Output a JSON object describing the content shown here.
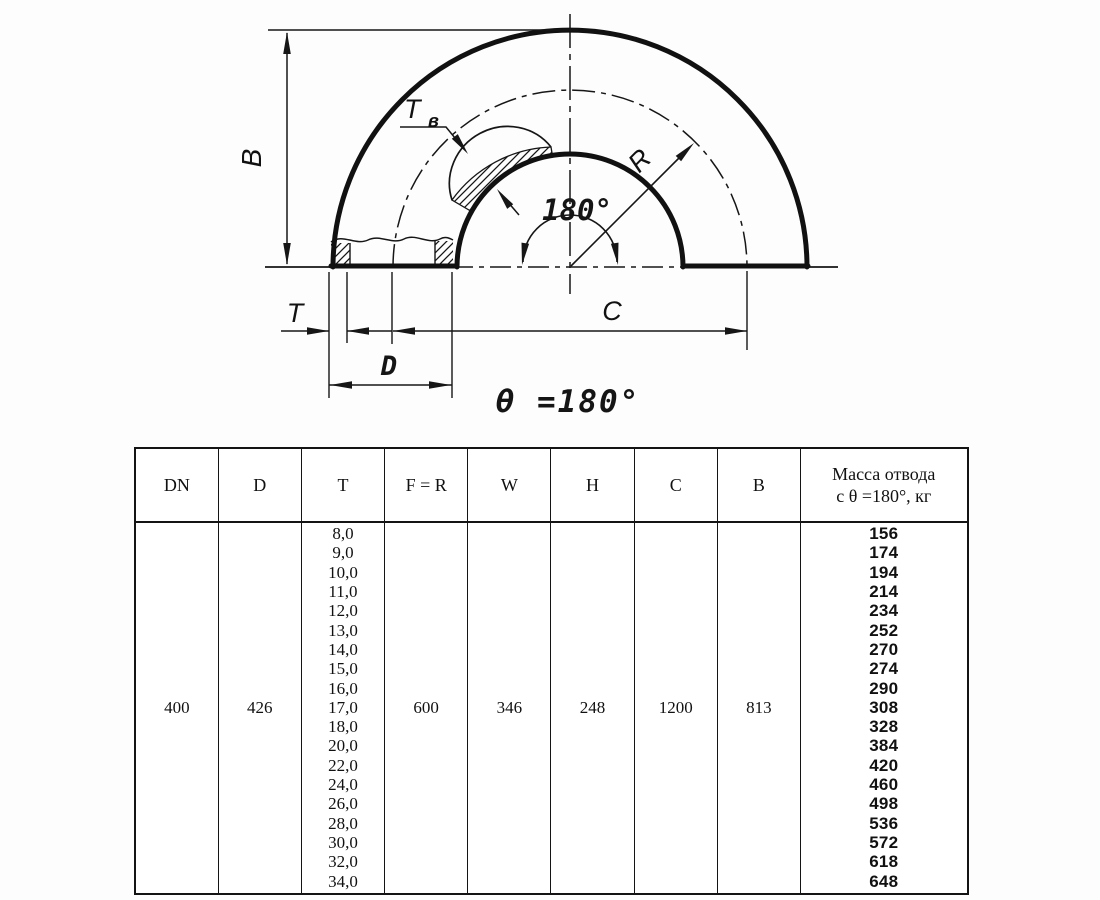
{
  "drawing": {
    "labels": {
      "dim_B": "B",
      "wall_label_main": "T",
      "wall_label_sub": "в",
      "radius_label": "R",
      "angle_label": "180°",
      "dim_C": "C",
      "dim_T": "T",
      "dim_D": "D",
      "caption": "θ =180°"
    }
  },
  "table": {
    "col_dn": {
      "header": "DN",
      "value": "400"
    },
    "col_d": {
      "header": "D",
      "value": "426"
    },
    "col_t": {
      "header": "T",
      "values": [
        "8,0",
        "9,0",
        "10,0",
        "11,0",
        "12,0",
        "13,0",
        "14,0",
        "15,0",
        "16,0",
        "17,0",
        "18,0",
        "20,0",
        "22,0",
        "24,0",
        "26,0",
        "28,0",
        "30,0",
        "32,0",
        "34,0"
      ]
    },
    "col_fr": {
      "header": "F = R",
      "value": "600"
    },
    "col_w": {
      "header": "W",
      "value": "346"
    },
    "col_h": {
      "header": "H",
      "value": "248"
    },
    "col_c": {
      "header": "C",
      "value": "1200"
    },
    "col_b": {
      "header": "B",
      "value": "813"
    },
    "col_mass": {
      "header_line1": "Масса отвода",
      "header_line2": "с θ =180°, кг",
      "values": [
        "156",
        "174",
        "194",
        "214",
        "234",
        "252",
        "270",
        "274",
        "290",
        "308",
        "328",
        "384",
        "420",
        "460",
        "498",
        "536",
        "572",
        "618",
        "648"
      ]
    }
  }
}
